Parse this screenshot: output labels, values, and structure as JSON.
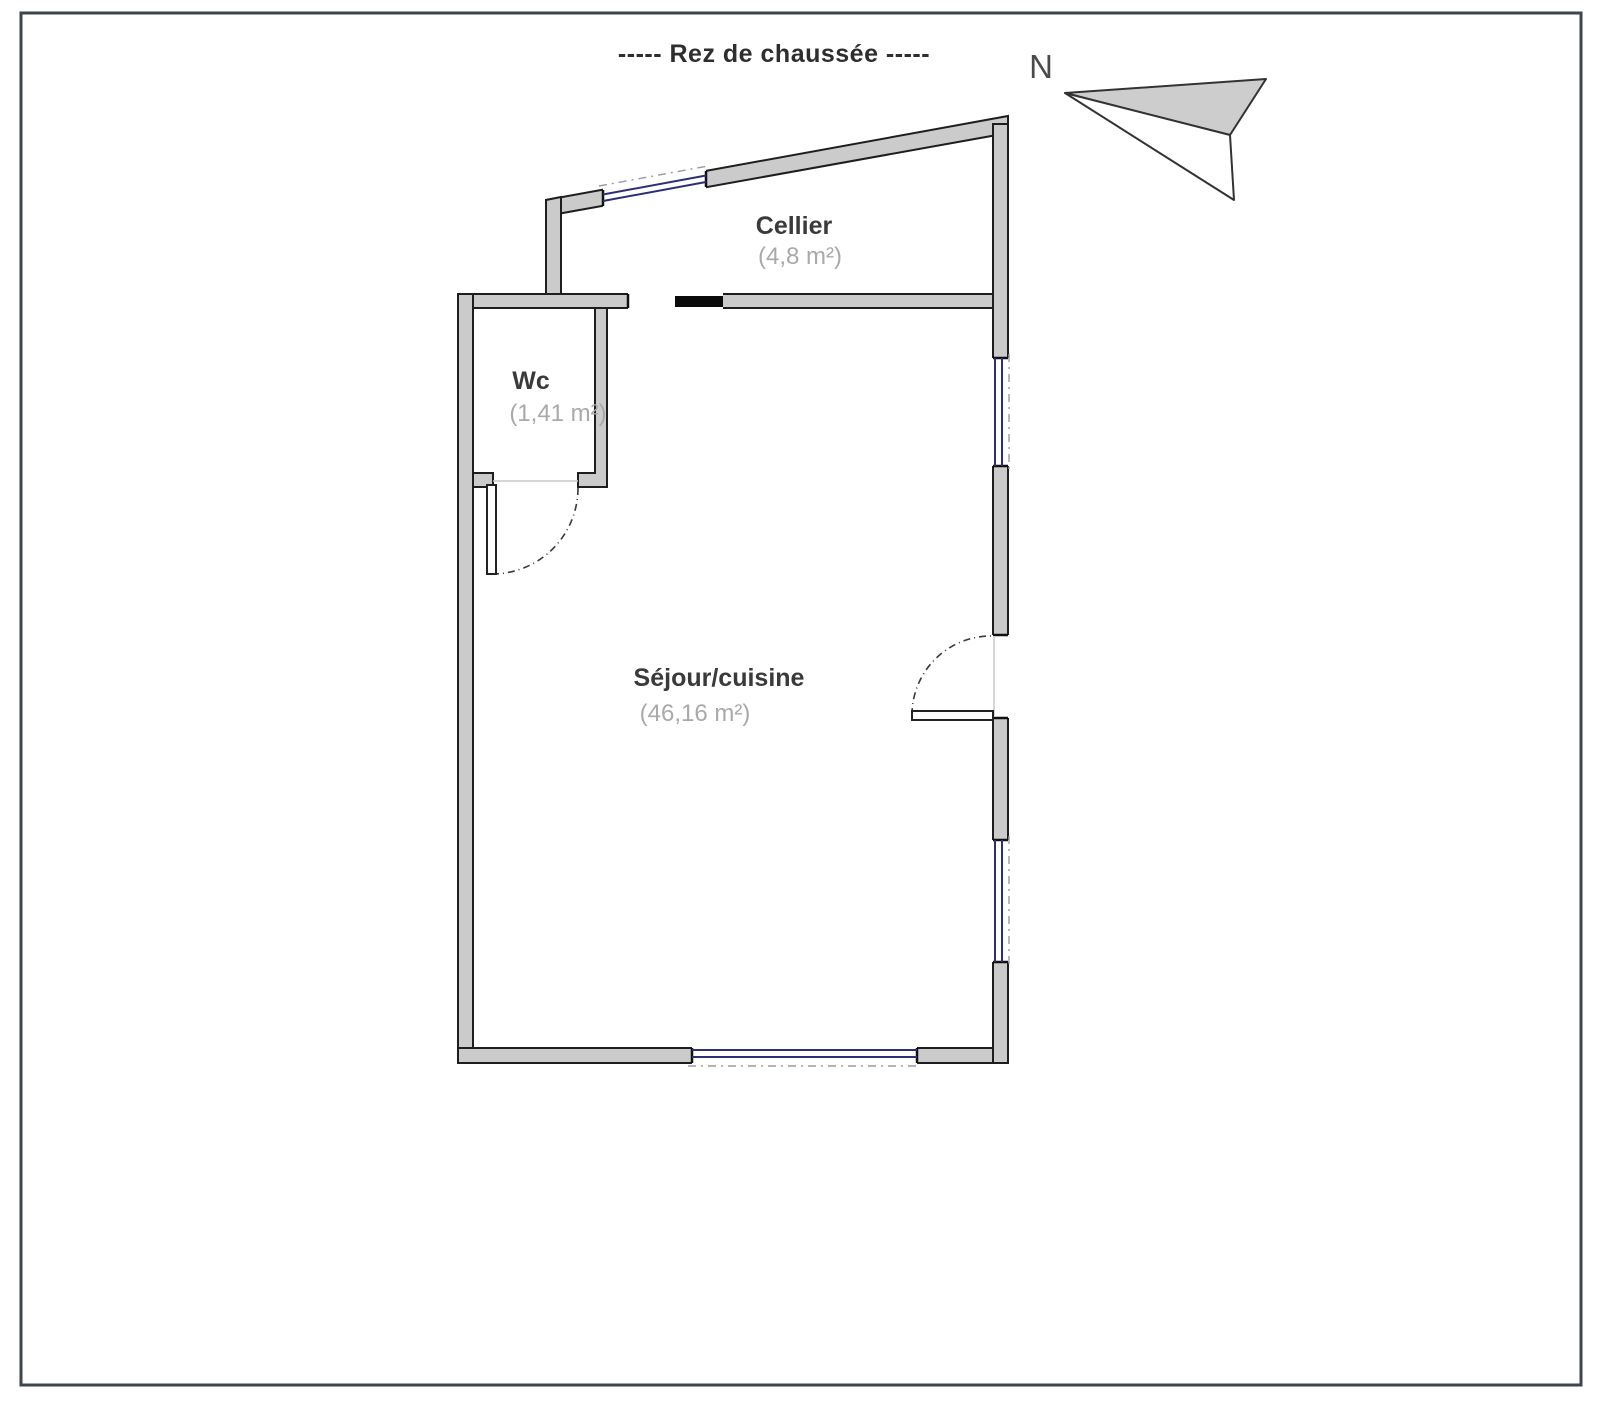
{
  "page": {
    "title": "-----  Rez de chaussée  -----"
  },
  "compass": {
    "label": "N"
  },
  "rooms": [
    {
      "name": "Cellier",
      "area": "(4,8 m²)"
    },
    {
      "name": "Wc",
      "area": "(1,41 m²)"
    },
    {
      "name": "Séjour/cuisine",
      "area": "(46,16 m²)"
    }
  ],
  "colors": {
    "wall_fill": "#cbcbcb",
    "wall_outline": "#1e1e1e",
    "window_line": "#2e2e78",
    "exterior_dash": "#9a9aa6",
    "page_border": "#3d464d",
    "area_text": "#a9a9a9",
    "name_text": "#3a3a3a"
  }
}
